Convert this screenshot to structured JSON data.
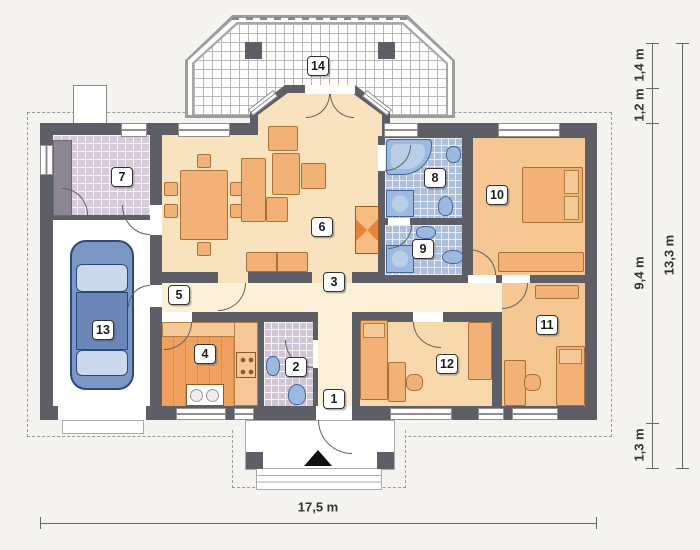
{
  "floorplan": {
    "rooms": [
      {
        "label": "1"
      },
      {
        "label": "2"
      },
      {
        "label": "3"
      },
      {
        "label": "4"
      },
      {
        "label": "5"
      },
      {
        "label": "6"
      },
      {
        "label": "7"
      },
      {
        "label": "8"
      },
      {
        "label": "9"
      },
      {
        "label": "10"
      },
      {
        "label": "11"
      },
      {
        "label": "12"
      },
      {
        "label": "13"
      },
      {
        "label": "14"
      }
    ],
    "dimensions": {
      "width_total": "17,5 m",
      "height_total": "13,3 m",
      "top_segment_1": "1,4 m",
      "top_segment_2": "1,2 m",
      "middle_segment": "9,4 m",
      "bottom_segment": "1,3 m"
    },
    "colors": {
      "wall": "#5e5e66",
      "living_floor": "#f9e3bf",
      "corridor_floor": "#fdf0d8",
      "bedroom_floor": "#f5c893",
      "room12_floor": "#f8d9ad",
      "kitchen_floor": "#ef9e5c",
      "bath_tile": "#aebfda",
      "entry_tile": "#d6cadb",
      "furniture": "#f2b277",
      "fixture": "#9cb9e0",
      "car": "#7b97c5"
    },
    "icons": {
      "entrance_arrow": "entrance-direction-marker"
    }
  }
}
